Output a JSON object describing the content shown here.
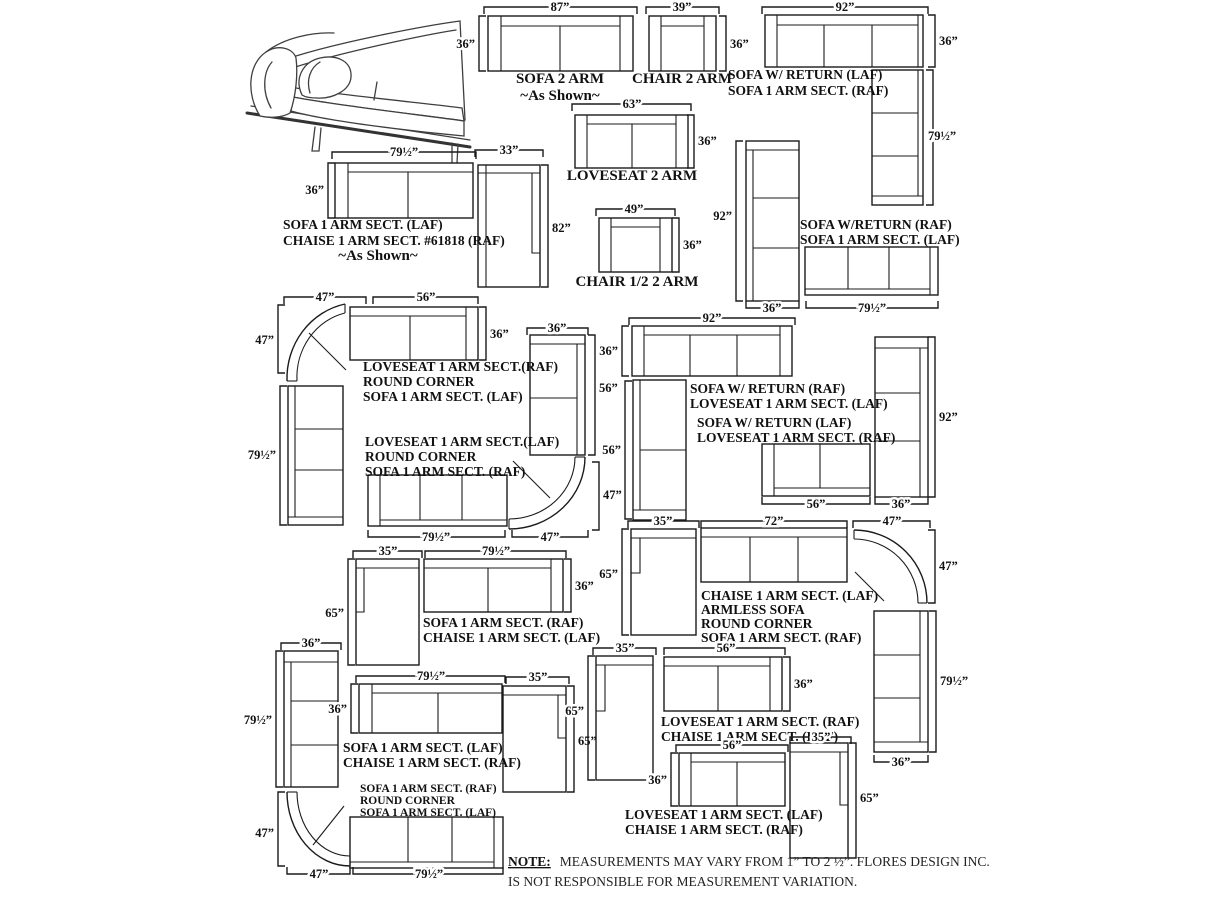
{
  "page": {
    "background": "#ffffff",
    "ink": "#1b1b1b"
  },
  "note": {
    "prefix": "NOTE:",
    "line1": "MEASUREMENTS MAY VARY FROM 1” TO 2 ½”. FLORES DESIGN INC.",
    "line2": "IS NOT RESPONSIBLE FOR MEASUREMENT VARIATION."
  },
  "configs": {
    "sofa2arm": {
      "w": "87”",
      "h": "36”",
      "name": "SOFA 2 ARM",
      "sub": "~As Shown~"
    },
    "chair2arm": {
      "w": "39”",
      "h": "36”",
      "name": "CHAIR 2 ARM"
    },
    "sofaReturnLAF": {
      "w": "92”",
      "h": "36”",
      "ret": "79½”",
      "l1": "SOFA W/ RETURN (LAF)",
      "l2": "SOFA 1 ARM SECT. (RAF)"
    },
    "loveseat2arm": {
      "w": "63”",
      "h": "36”",
      "name": "LOVESEAT 2 ARM"
    },
    "sofaChaise61818": {
      "sw": "79½”",
      "sh": "36”",
      "cw": "33”",
      "ch": "82”",
      "l1": "SOFA 1 ARM SECT. (LAF)",
      "l2": "CHAISE 1 ARM SECT. #61818 (RAF)",
      "l3": "~As Shown~"
    },
    "chairHalf": {
      "w": "49”",
      "h": "36”",
      "name": "CHAIR 1/2 2 ARM"
    },
    "sofaReturnRAF": {
      "v": "92”",
      "vw": "36”",
      "sw": "79½”",
      "l1": "SOFA W/RETURN (RAF)",
      "l2": "SOFA 1 ARM SECT. (LAF)"
    },
    "cornerRAF": {
      "kw": "47”",
      "kh": "47”",
      "lw": "56”",
      "lh": "36”",
      "sv": "79½”",
      "l1": "LOVESEAT 1 ARM SECT.(RAF)",
      "l2": "ROUND CORNER",
      "l3": "SOFA 1 ARM SECT. (LAF)"
    },
    "cornerLAF": {
      "lw": "36”",
      "lh": "56”",
      "kw": "47”",
      "kh": "47”",
      "sw": "79½”",
      "l1": "LOVESEAT 1 ARM SECT.(LAF)",
      "l2": "ROUND CORNER",
      "l3": "SOFA 1 ARM SECT. (RAF)"
    },
    "returnLoveseatRAF": {
      "w": "92”",
      "h": "36”",
      "lh": "56”",
      "l1": "SOFA W/ RETURN (RAF)",
      "l2": "LOVESEAT 1 ARM SECT. (LAF)"
    },
    "returnLoveseatLAF": {
      "lw": "56”",
      "v": "92”",
      "vw": "36”",
      "l1": "SOFA W/ RETURN (LAF)",
      "l2": "LOVESEAT 1 ARM SECT. (RAF)"
    },
    "sofaChaiseRAF": {
      "cw": "35”",
      "ch": "65”",
      "sw": "79½”",
      "sh": "36”",
      "l1": "SOFA 1 ARM SECT. (RAF)",
      "l2": "CHAISE 1 ARM SECT. (LAF)"
    },
    "chaiseArmlessCorner": {
      "cw": "35”",
      "ch": "65”",
      "aw": "72”",
      "kw": "47”",
      "kh": "47”",
      "sv": "79½”",
      "svw": "36”",
      "l1": "CHAISE 1 ARM SECT. (LAF)",
      "l2": "ARMLESS SOFA",
      "l3": "ROUND CORNER",
      "l4": "SOFA 1 ARM SECT. (RAF)"
    },
    "cornerSofaSofa": {
      "vw": "36”",
      "v": "79½”",
      "kh": "47”",
      "kw": "47”",
      "sw": "79½”",
      "l1": "SOFA 1 ARM SECT. (RAF)",
      "l2": "ROUND CORNER",
      "l3": "SOFA 1 ARM SECT. (LAF)"
    },
    "sofaChaiseLAF": {
      "sw": "79½”",
      "sh": "36”",
      "cw": "35”",
      "ch": "65”",
      "l1": "SOFA 1 ARM SECT. (LAF)",
      "l2": "CHAISE 1 ARM SECT. (RAF)"
    },
    "loveseatChaiseRAF": {
      "cw": "35”",
      "ch": "65”",
      "lw": "56”",
      "lh": "36”",
      "l1": "LOVESEAT 1 ARM SECT. (RAF)",
      "l2": "CHAISE 1 ARM SECT. (LAF)"
    },
    "loveseatChaiseLAF": {
      "lw": "56”",
      "lh": "36”",
      "cw": "35”",
      "ch": "65”",
      "l1": "LOVESEAT 1 ARM SECT. (LAF)",
      "l2": "CHAISE 1 ARM SECT. (RAF)"
    }
  }
}
